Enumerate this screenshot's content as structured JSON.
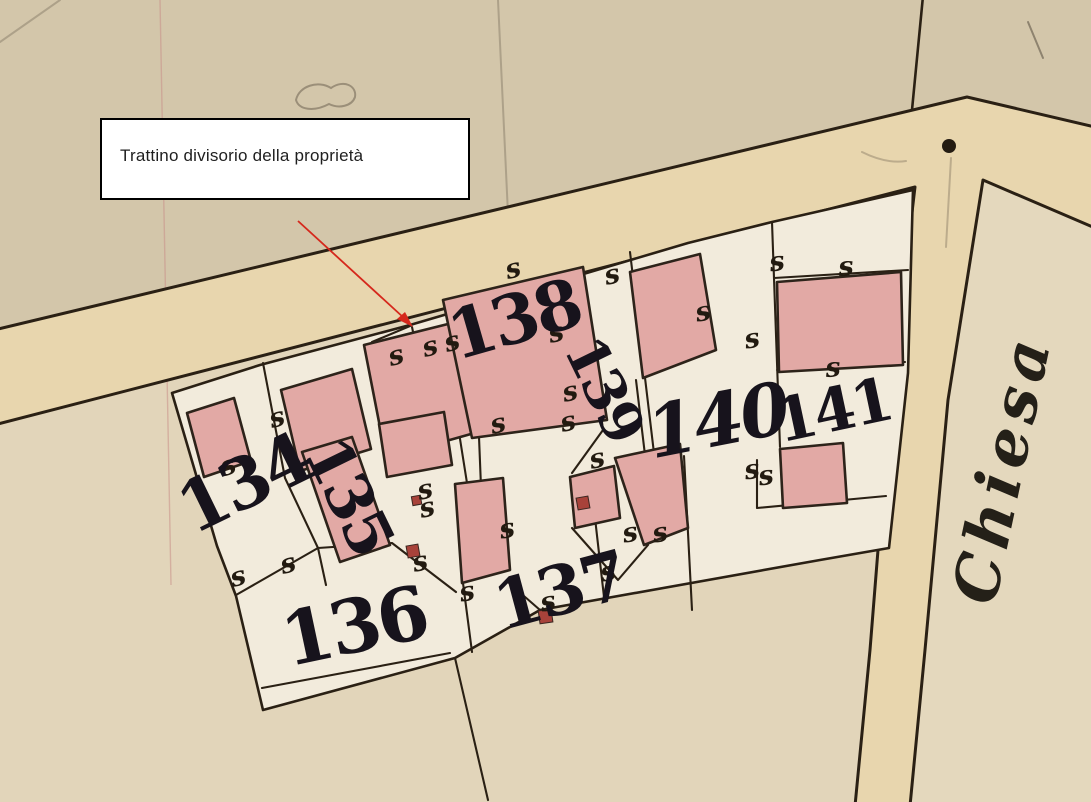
{
  "map": {
    "annotation": {
      "text": "Trattino divisorio della proprietà"
    },
    "street": {
      "name": "Chiesa"
    },
    "parcels": [
      {
        "number": "134"
      },
      {
        "number": "135"
      },
      {
        "number": "136"
      },
      {
        "number": "137"
      },
      {
        "number": "138"
      },
      {
        "number": "139"
      },
      {
        "number": "140"
      },
      {
        "number": "141"
      }
    ],
    "survey_mark": "s",
    "colors": {
      "paper": "#e2d5ba",
      "paper-top": "#d3c6aa",
      "paper-right": "#e4d8bd",
      "block": "#f2ebdc",
      "road": "#e8d6ae",
      "line": "#2a2014",
      "building": "#e2a9a5",
      "building-line": "#2d231a",
      "number": "#17131c",
      "arrow": "#d5281c",
      "accent-square": "#a8423a",
      "crease": "#c98f88",
      "label-text": "#1f1f1f",
      "label-border": "#000000"
    }
  }
}
